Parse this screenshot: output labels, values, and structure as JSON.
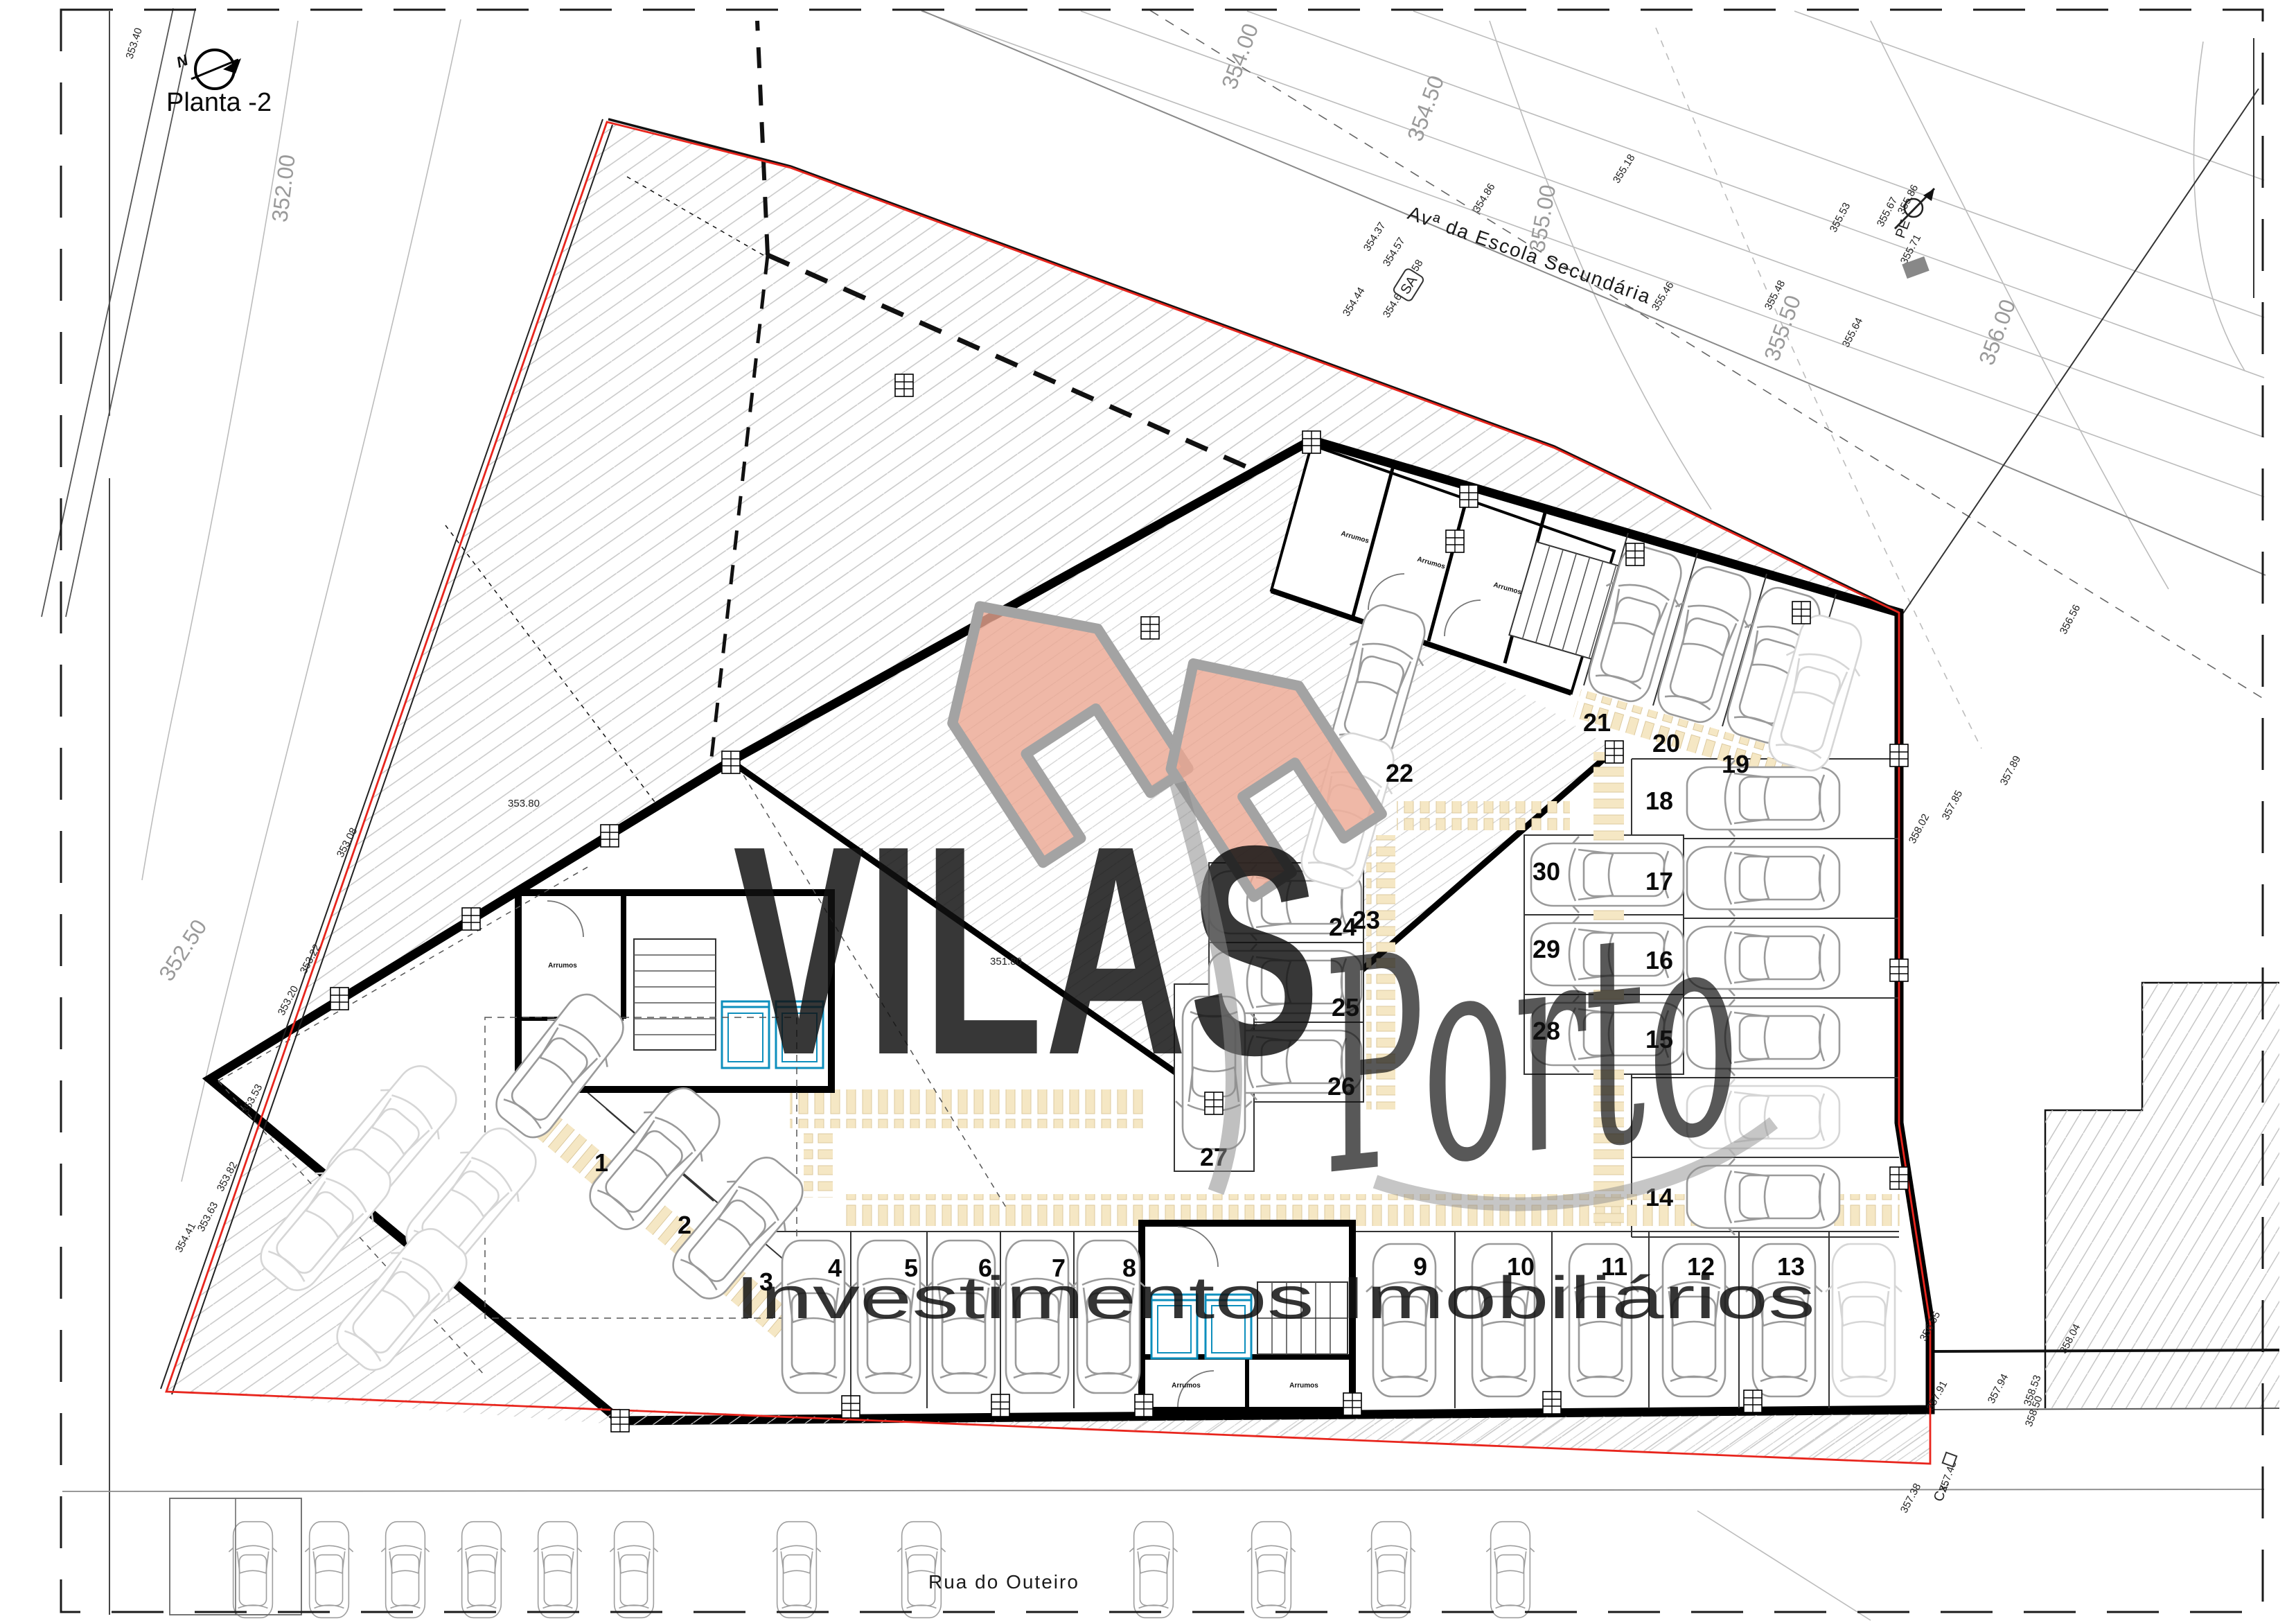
{
  "plan": {
    "title": "Planta -2",
    "north_letter": "N"
  },
  "streets": {
    "top": "Avª da Escola Secundária",
    "bottom": "Rua do Outeiro"
  },
  "watermark": {
    "brand": "VILAS",
    "script": "Porto",
    "tagline": "Investimentos Imobiliários"
  },
  "rooms": {
    "storage": "Arrumos"
  },
  "parking": {
    "numbers": [
      "1",
      "2",
      "3",
      "4",
      "5",
      "6",
      "7",
      "8",
      "9",
      "10",
      "11",
      "12",
      "13",
      "14",
      "15",
      "16",
      "17",
      "18",
      "19",
      "20",
      "21",
      "22",
      "23",
      "24",
      "25",
      "26",
      "27",
      "28",
      "29",
      "30"
    ]
  },
  "survey": {
    "contours": [
      "352.00",
      "352.50",
      "354.00",
      "354.50",
      "355.00",
      "355.50",
      "356.00"
    ],
    "spots": [
      "351.80",
      "353.08",
      "353.20",
      "353.22",
      "353.40",
      "353.53",
      "353.63",
      "353.80",
      "353.82",
      "354.37",
      "354.41",
      "354.44",
      "354.57",
      "354.58",
      "354.60",
      "354.86",
      "355.18",
      "355.46",
      "355.48",
      "355.53",
      "355.64",
      "355.67",
      "355.71",
      "355.86",
      "356.55",
      "356.56",
      "357.38",
      "357.43",
      "357.85",
      "357.89",
      "357.91",
      "357.94",
      "358.02",
      "358.04",
      "358.50",
      "358.53"
    ],
    "markers": {
      "pe": "PE",
      "sa": "SA",
      "cx": "Cx."
    }
  },
  "colors": {
    "accent": "#E8A28D",
    "script_gray": "#8D8D8D",
    "elevator": "#0D8FBD",
    "boundary_red": "#E8251D",
    "walkway_tan": "#F5E7C4"
  }
}
